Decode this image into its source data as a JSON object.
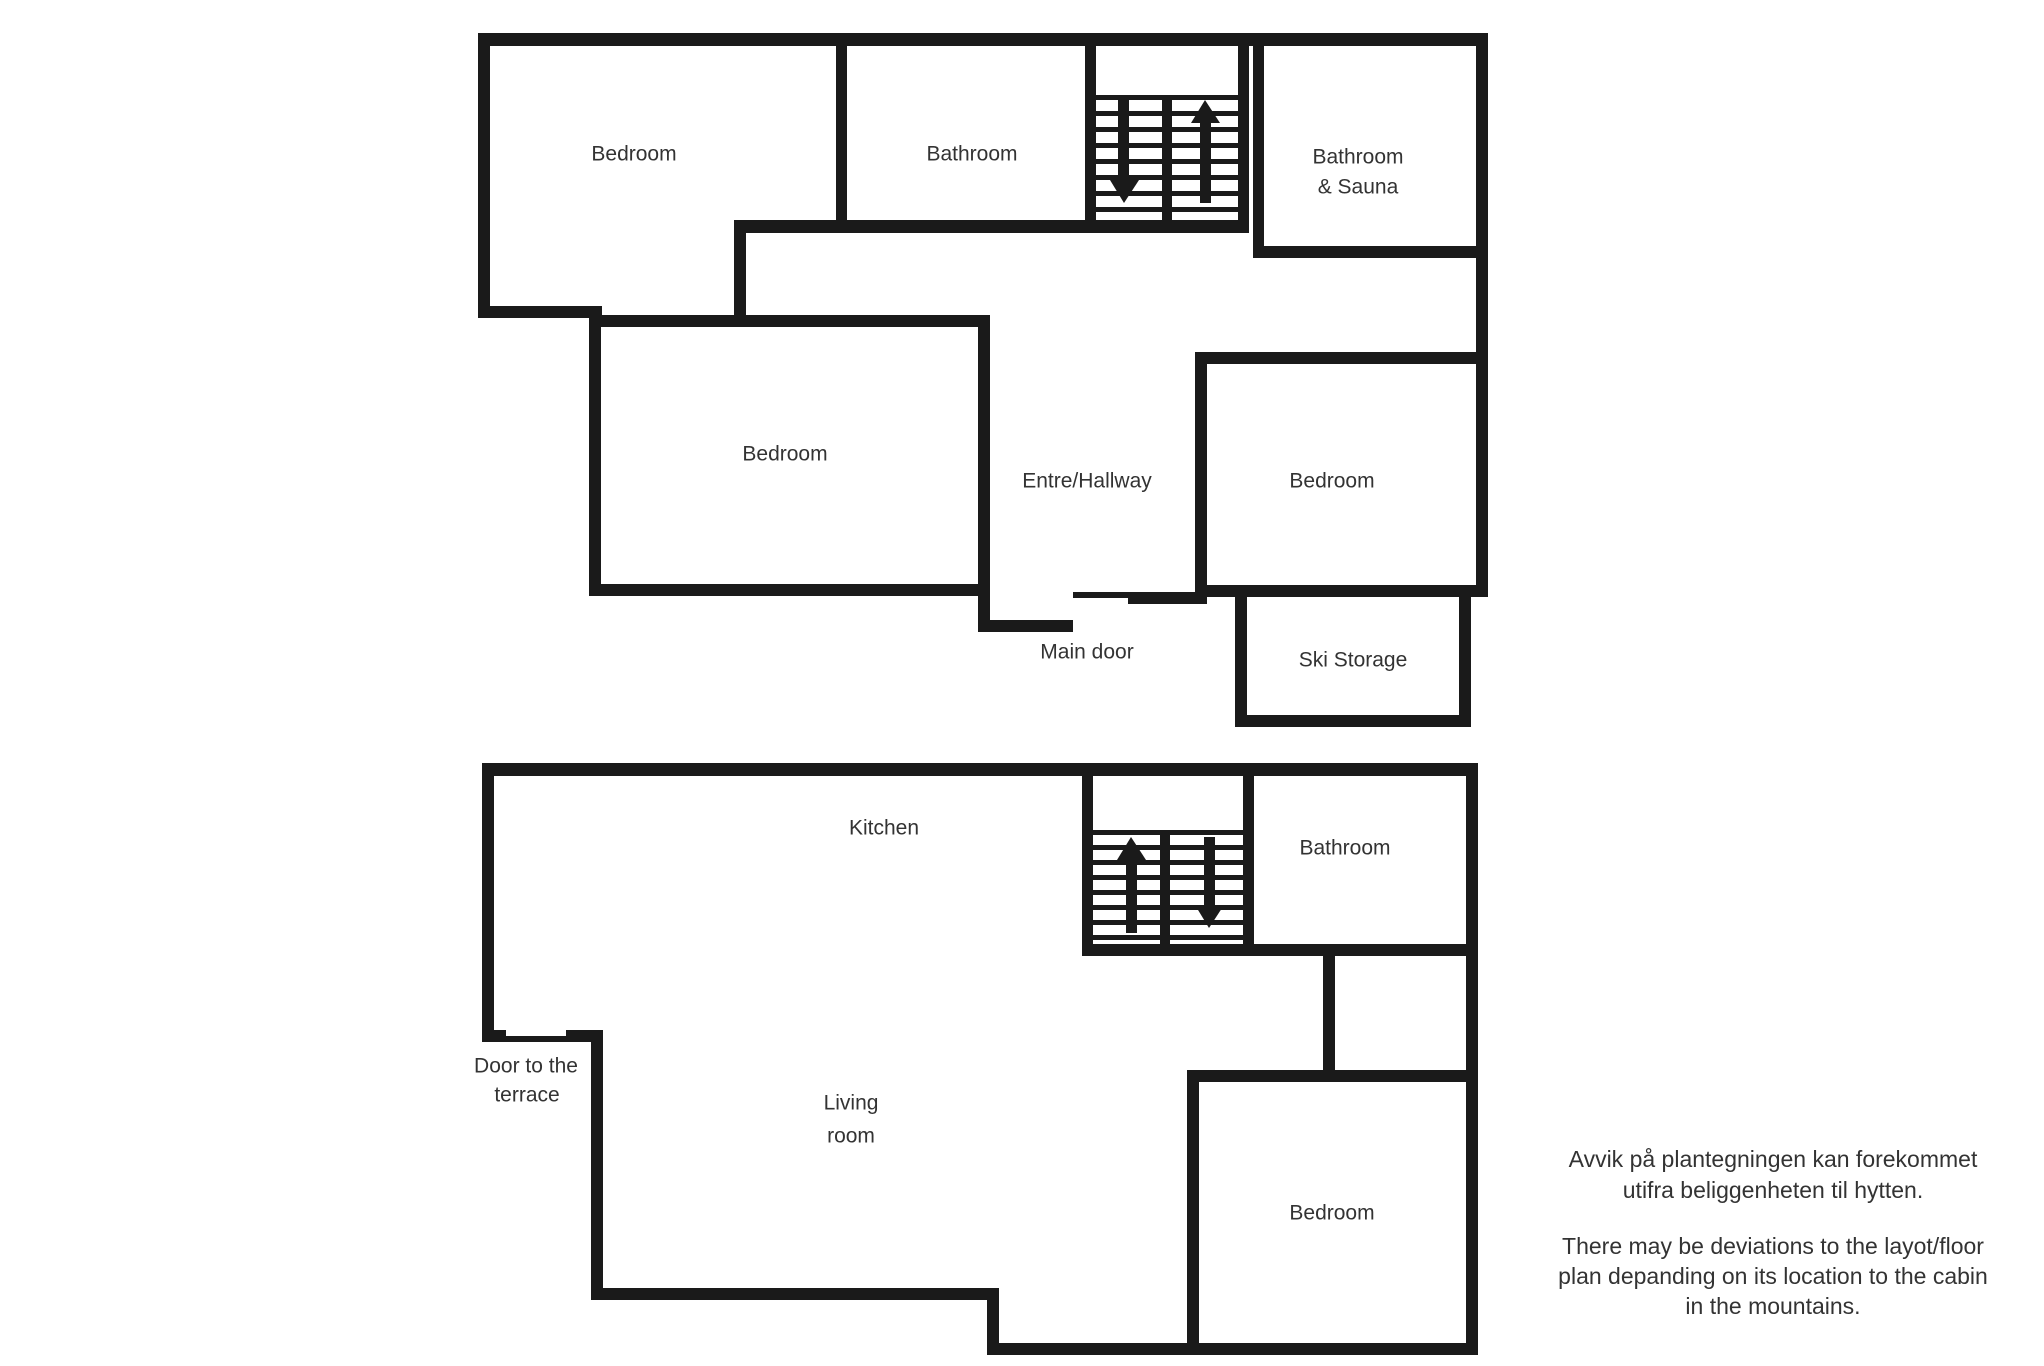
{
  "colors": {
    "background": "#ffffff",
    "wall": "#1a1a1a",
    "text": "#333333"
  },
  "upper_floor": {
    "labels": {
      "bedroom_left": "Bedroom",
      "bathroom": "Bathroom",
      "bathroom_sauna_1": "Bathroom",
      "bathroom_sauna_2": "& Sauna",
      "bedroom_middle": "Bedroom",
      "hallway": "Entre/Hallway",
      "bedroom_right": "Bedroom",
      "main_door": "Main door",
      "ski_storage": "Ski Storage"
    },
    "stairs": {
      "down_icon": "arrow-down-icon",
      "up_icon": "arrow-up-icon"
    }
  },
  "lower_floor": {
    "labels": {
      "kitchen": "Kitchen",
      "bathroom": "Bathroom",
      "living_1": "Living",
      "living_2": "room",
      "terrace_1": "Door to the",
      "terrace_2": "terrace",
      "bedroom": "Bedroom"
    },
    "stairs": {
      "up_icon": "arrow-up-icon",
      "down_icon": "arrow-down-icon"
    }
  },
  "disclaimer": {
    "norwegian": [
      "Avvik på plantegningen kan forekommet",
      "utifra beliggenheten til hytten."
    ],
    "english": [
      "There may be deviations to the layot/floor",
      "plan depanding on its location to the cabin",
      "in the mountains."
    ]
  }
}
